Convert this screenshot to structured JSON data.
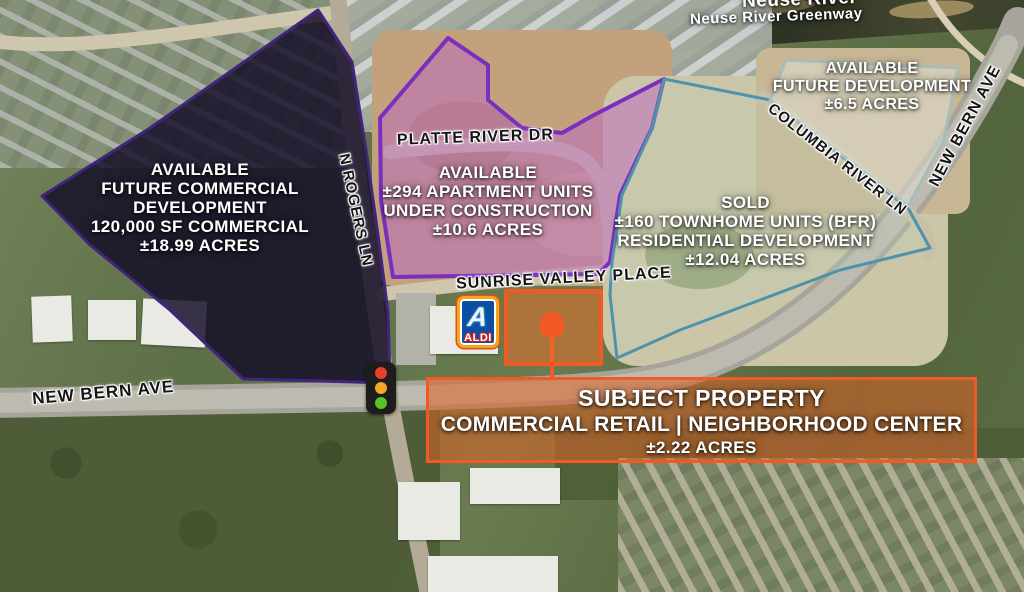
{
  "theme": {
    "colors": {
      "dark_fill": "rgba(17,10,38,0.82)",
      "dark_stroke": "#41257c",
      "purple_fill": "rgba(189,109,190,0.55)",
      "purple_stroke": "#7b2fbe",
      "teal_fill": "rgba(190,207,184,0.28)",
      "teal_stroke": "#4e93a9",
      "tr_fill": "rgba(224,226,212,0.5)",
      "tr_stroke": "#a8bdbb",
      "orange_fill": "rgba(240,110,35,0.5)",
      "orange_stroke": "#f15a24",
      "subject_fill": "rgba(222,99,38,0.55)",
      "signal_red": "#e8402a",
      "signal_amber": "#f5a623",
      "signal_green": "#58c322"
    }
  },
  "map": {
    "water": {
      "river": "Neuse River",
      "greenway": "Neuse River Greenway"
    },
    "roads": {
      "platte_river_dr": "PLATTE RIVER DR",
      "n_rogers_ln": "N ROGERS LN",
      "sunrise_valley_place": "SUNRISE VALLEY PLACE",
      "new_bern_ave_west": "NEW BERN AVE",
      "new_bern_ave_east": "NEW BERN AVE",
      "columbia_river_ln": "COLUMBIA RIVER LN"
    },
    "parcels": {
      "future_commercial": {
        "lines": [
          "AVAILABLE",
          "FUTURE COMMERCIAL DEVELOPMENT",
          "120,000 SF COMMERCIAL",
          "±18.99 ACRES"
        ]
      },
      "apartments": {
        "lines": [
          "AVAILABLE",
          "±294 APARTMENT UNITS",
          "UNDER CONSTRUCTION",
          "±10.6 ACRES"
        ]
      },
      "townhomes": {
        "lines": [
          "SOLD",
          "±160 TOWNHOME UNITS (BFR)",
          "RESIDENTIAL DEVELOPMENT",
          "±12.04 ACRES"
        ]
      },
      "future_dev_northeast": {
        "lines": [
          "AVAILABLE",
          "FUTURE DEVELOPMENT",
          "±6.5 ACRES"
        ]
      },
      "subject_property": {
        "lines": [
          "SUBJECT PROPERTY",
          "COMMERCIAL RETAIL | NEIGHBORHOOD CENTER",
          "±2.22 ACRES"
        ]
      }
    },
    "poi": {
      "aldi_monogram": "A",
      "aldi": "ALDI"
    }
  }
}
